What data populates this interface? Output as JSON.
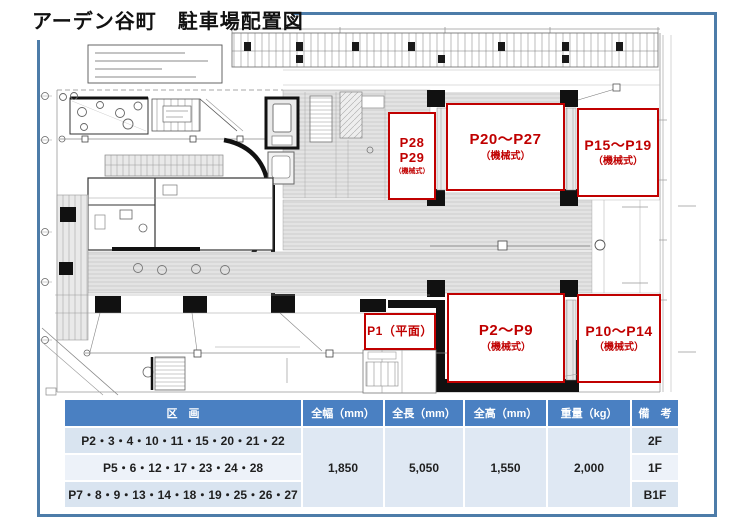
{
  "title": "アーデン谷町　駐車場配置図",
  "colors": {
    "accent_red": "#c00000",
    "frame_blue": "#4d7ca9",
    "table_header_blue": "#4a80c2"
  },
  "plan_labels": {
    "p28_29": {
      "line1": "P28",
      "line2": "P29",
      "sub": "（機械式）"
    },
    "p20_27": {
      "main": "P20～P27",
      "sub": "（機械式）"
    },
    "p15_19": {
      "main": "P15～P19",
      "sub": "（機械式）"
    },
    "p1": {
      "main": "P1（平面）"
    },
    "p2_9": {
      "main": "P2～P9",
      "sub": "（機械式）"
    },
    "p10_14": {
      "main": "P10～P14",
      "sub": "（機械式）"
    }
  },
  "table": {
    "headers": [
      "区　画",
      "全幅（mm）",
      "全長（mm）",
      "全高（mm）",
      "重量（kg）",
      "備　考"
    ],
    "rows": [
      {
        "section": "P2・3・4・10・11・15・20・21・22",
        "note": "2F"
      },
      {
        "section": "P5・6・12・17・23・24・28",
        "note": "1F"
      },
      {
        "section": "P7・8・9・13・14・18・19・25・26・27",
        "note": "B1F"
      }
    ],
    "specs": {
      "width_mm": "1,850",
      "length_mm": "5,050",
      "height_mm": "1,550",
      "weight_kg": "2,000"
    }
  }
}
